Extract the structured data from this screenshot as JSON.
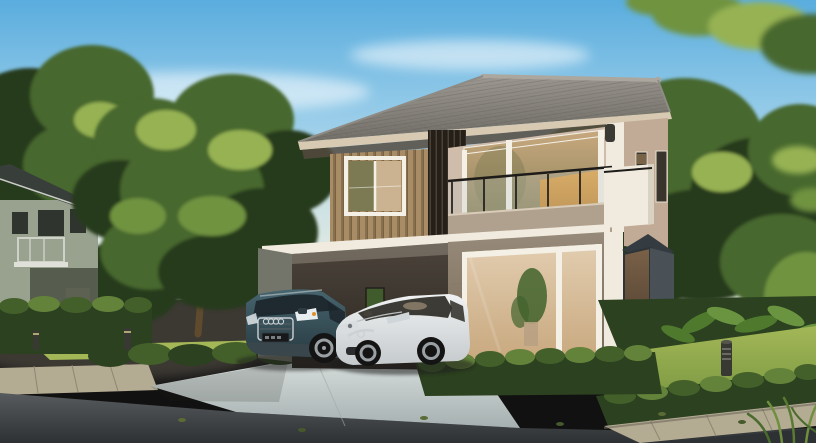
{
  "scene": {
    "kind": "photorealistic 3D exterior rendering of a modern two-storey detached house",
    "time_of_day": "late afternoon, warm sunlight from the left, clear blue sky with soft clouds",
    "visible_text": "none (license plate present but illegible)",
    "main_house": {
      "label": "modern two-storey house",
      "roof": "grey concrete-tile hip roof with round ridge caps and cream fascia",
      "upper_floor": "vertical wood-clad section with white sliding window, dark timber slat screen, beige stucco wall, full-height sliding glass doors with warm interior glow, balcony with black-framed glass railing and white corner parapet, two slim side windows, bronze wall lamp",
      "ground_floor": "taupe stucco wall, large white-framed sliding glass doors with indoor plant, white corner pillars, dark slate bay window, flat-roofed carport with white slab edge"
    },
    "neighbor_house": {
      "label": "neighbouring two-storey house",
      "details": "grey-green walls, dark tiled roof, small balcony with white railing, dark lower wing, trimmed hedge in front"
    },
    "vehicles": [
      {
        "label": "dark teal Audi SUV parked under the carport",
        "body_color_key": "suv_body",
        "emblem": "four-ring grille badge",
        "plate": "dark unreadable plate"
      },
      {
        "label": "white Mazda hatchback parked on the driveway",
        "body_color_key": "sedan_body",
        "emblem": "winged grille badge"
      }
    ],
    "landscape": [
      "large leafy tree between the houses",
      "dense background trees behind and right of the house",
      "overhanging blurred branch in the top-right corner",
      "tall trimmed hedge at left with sunlit lawn strip and low shrub row",
      "low trimmed hedge in front of the porch",
      "tropical broad-leaf planting bed on the right",
      "sunlit lawn with cylindrical bollard path lights (two left, one right)",
      "tall grass blades in the bottom-right corner"
    ],
    "ground": [
      "light concrete driveway apron",
      "stone paver walkway and kerb strips",
      "dark asphalt road across the foreground with scattered fallen leaves"
    ]
  },
  "palette": {
    "sky_top": "#5aadde",
    "sky_mid": "#a9d5ec",
    "sky_horizon": "#eef2e6",
    "cloud": "#ffffff",
    "foliage_dark": "#263a1e",
    "foliage_mid": "#47672f",
    "foliage_light": "#6f9340",
    "foliage_sunlit": "#96b252",
    "trunk": "#5f4a2e",
    "neighbor_wall": "#99a18f",
    "neighbor_wall_dark": "#565c4e",
    "neighbor_roof": "#383e3a",
    "neighbor_window": "#2f352e",
    "roof_light": "#a39f98",
    "roof_dark": "#6f6b65",
    "roof_ridge": "#aba79f",
    "fascia": "#d7c9b2",
    "eave_shadow": "#554a40",
    "wood_base": "#a88c66",
    "wood_stripe": "#8a6f4e",
    "wood_dark": "#6d5639",
    "slat_dark": "#241f19",
    "slat_light": "#4c4134",
    "wall_beige": "#d0bcaa",
    "wall_beige_dark": "#c2ab96",
    "wall_white": "#f1ebdf",
    "wall_white_shade": "#d9d2c2",
    "wall_ground": "#978a7a",
    "wall_ground_dark": "#746753",
    "frame_white": "#f4f0e6",
    "glass_warm": "#c8a87e",
    "glass_amber": "#eda43e",
    "glass_tree": "#7c7a52",
    "glass_dark": "#3a352c",
    "interior_beige": "#b9a789",
    "plant_green": "#41632c",
    "rail_black": "#1e1c19",
    "rail_glass": "#b9c7c2",
    "parapet": "#b0a08e",
    "bay_gray": "#495056",
    "bay_gray_dark": "#343b41",
    "bay_glass": "#7a6148",
    "carport_dark": "#2b2621",
    "carport_mid": "#4c443b",
    "carport_wall": "#73756a",
    "hedge_dark": "#2c411f",
    "hedge_mid": "#44602a",
    "hedge_light": "#64833a",
    "lawn_light": "#a3b757",
    "lawn_mid": "#7d9a43",
    "lawn_dark": "#506f2e",
    "tropical": "#4f7a2e",
    "tropical_light": "#6a9440",
    "drive_light": "#d6dedc",
    "drive_dark": "#a6b0b0",
    "paver": "#b4ab93",
    "paver_dark": "#8e8672",
    "road_light": "#575b5d",
    "road_dark": "#2d3133",
    "suv_body": "#47656f",
    "suv_dark": "#283a41",
    "suv_glass": "#1c252b",
    "sedan_body": "#f0f2f2",
    "sedan_shade": "#c5cacd",
    "sedan_glass": "#2e2b25",
    "chrome": "#ccd1d4",
    "wheel_dark": "#141414",
    "rim": "#9aa0a4",
    "bollard": "#393933",
    "lamp": "#3b3934",
    "shadow": "#1d1d1b",
    "warm_haze": "#ffeccb"
  }
}
